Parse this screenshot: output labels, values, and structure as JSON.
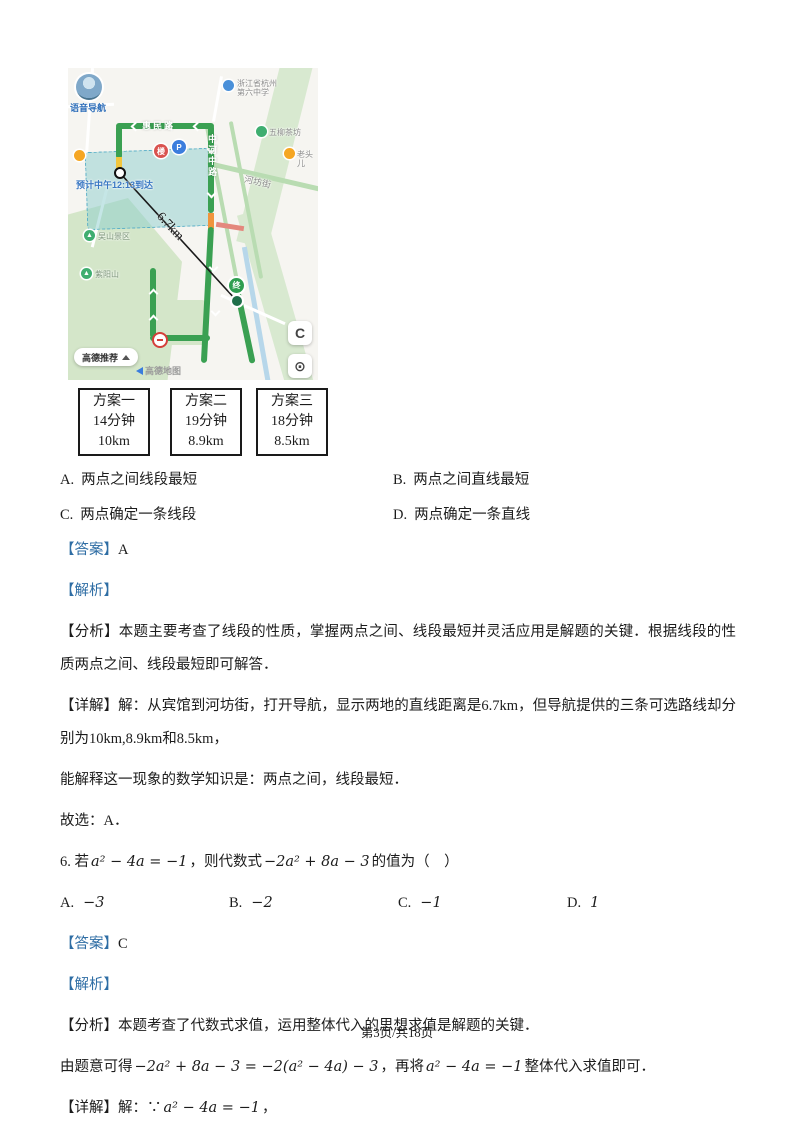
{
  "page": {
    "footer": "第3页/共18页"
  },
  "map": {
    "voice_nav_label": "语音导航",
    "eta_label": "预计中午12:13到达",
    "distance_label": "6.7km",
    "recommend_button": "高德推荐",
    "watermark": "高德地图",
    "icons": {
      "refresh": "C",
      "locate": "⊙"
    },
    "roads": {
      "huimin": "惠民路",
      "zhonghe_mid": "中河中路",
      "hefang": "河坊街"
    },
    "pois": {
      "school_line1": "浙江省杭州",
      "school_line2": "第六中学",
      "teahouse": "五柳茶坊",
      "restaurant": "老头儿",
      "park1": "吴山景区",
      "park2": "紫阳山"
    },
    "markers": {
      "destination": "终",
      "parking": "P",
      "building": "楼"
    }
  },
  "plans": [
    {
      "name": "方案一",
      "time": "14分钟",
      "distance": "10km"
    },
    {
      "name": "方案二",
      "time": "19分钟",
      "distance": "8.9km"
    },
    {
      "name": "方案三",
      "time": "18分钟",
      "distance": "8.5km"
    }
  ],
  "q5": {
    "options": [
      {
        "label": "A.",
        "text": "两点之间线段最短"
      },
      {
        "label": "B.",
        "text": "两点之间直线最短"
      },
      {
        "label": "C.",
        "text": "两点确定一条线段"
      },
      {
        "label": "D.",
        "text": "两点确定一条直线"
      }
    ],
    "answer_tag": "【答案】",
    "answer": "A",
    "jiexi_tag": "【解析】",
    "fenxi": "【分析】本题主要考查了线段的性质，掌握两点之间、线段最短并灵活应用是解题的关键．根据线段的性质两点之间、线段最短即可解答．",
    "xiangjie": "【详解】解：从宾馆到河坊街，打开导航，显示两地的直线距离是6.7km，但导航提供的三条可选路线却分别为10km,8.9km和8.5km，",
    "explain": "能解释这一现象的数学知识是：两点之间，线段最短．",
    "choose": "故选：A．"
  },
  "q6": {
    "stem": {
      "pre": "6. 若",
      "math1": "a² − 4a = −1",
      "mid": "，则代数式",
      "math2": "−2a² + 8a − 3",
      "post": "的值为（　）"
    },
    "options": [
      {
        "label": "A.",
        "text": "−3"
      },
      {
        "label": "B.",
        "text": "−2"
      },
      {
        "label": "C.",
        "text": "−1"
      },
      {
        "label": "D.",
        "text": "1"
      }
    ],
    "answer_tag": "【答案】",
    "answer": "C",
    "jiexi_tag": "【解析】",
    "fenxi": "【分析】本题考查了代数式求值，运用整体代入的思想求值是解题的关键．",
    "derive": {
      "pre": "由题意可得",
      "math1": "−2a² + 8a − 3 = −2(a² − 4a) − 3",
      "mid": "，再将",
      "math2": "a² − 4a = −1",
      "post": "整体代入求值即可．"
    },
    "detail": {
      "tag": "【详解】",
      "pre": "解：∵",
      "math": "a² − 4a = −1",
      "post": "，"
    }
  }
}
